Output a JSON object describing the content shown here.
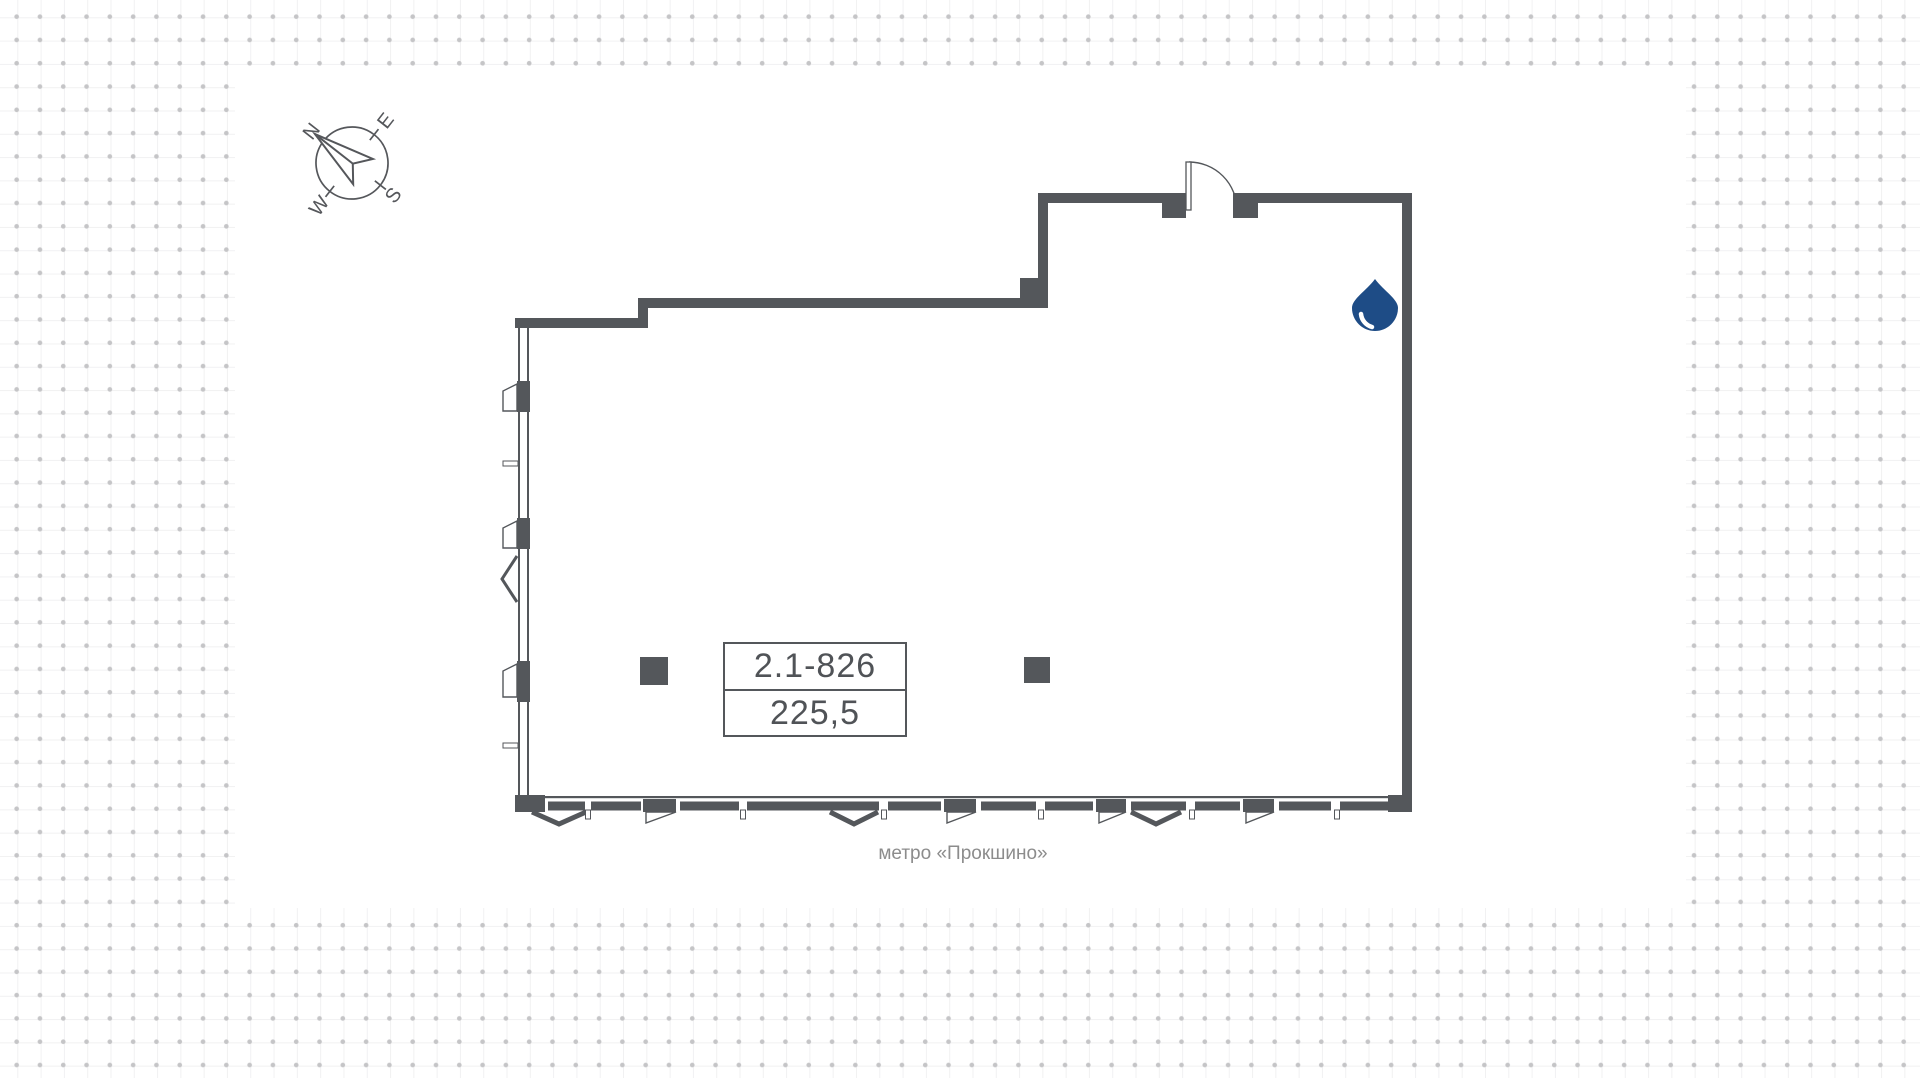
{
  "unit": {
    "code": "2.1-826",
    "area": "225,5"
  },
  "captions": {
    "metro": "метро «Прокшино»"
  },
  "compass": {
    "north": "N",
    "east": "E",
    "south": "S",
    "west": "W"
  },
  "icons": {
    "compass": "compass-rose-icon",
    "water_point": "water-drop-icon",
    "door": "door-swing-icon"
  },
  "colors": {
    "wall": "#54575b",
    "accent_blue": "#1e4c86",
    "label_text": "#505357",
    "caption_text": "#8c8c8c",
    "dot": "#c5c5c7",
    "gridline": "#f1f1f2",
    "canvas_bg": "#ffffff"
  }
}
